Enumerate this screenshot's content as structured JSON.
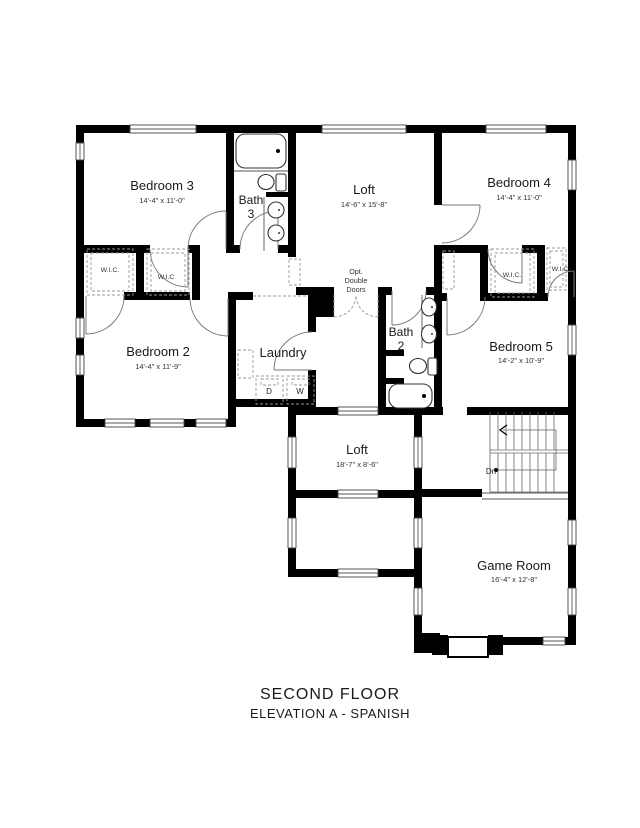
{
  "title": {
    "line1": "SECOND FLOOR",
    "line2": "ELEVATION A - SPANISH"
  },
  "rooms": {
    "bedroom3": {
      "name": "Bedroom 3",
      "dims": "14'-4\" x 11'-0\""
    },
    "bath3": {
      "name": "Bath",
      "number": "3"
    },
    "loft_upper": {
      "name": "Loft",
      "dims": "14'-6\" x 15'-8\""
    },
    "bedroom4": {
      "name": "Bedroom 4",
      "dims": "14'-4\" x 11'-0\""
    },
    "bedroom2": {
      "name": "Bedroom 2",
      "dims": "14'-4\" x 11'-9\""
    },
    "laundry": {
      "name": "Laundry"
    },
    "bath2": {
      "name": "Bath",
      "number": "2"
    },
    "bedroom5": {
      "name": "Bedroom 5",
      "dims": "14'-2\" x 10'-9\""
    },
    "loft_lower": {
      "name": "Loft",
      "dims": "18'-7\" x 8'-6\""
    },
    "game_room": {
      "name": "Game Room",
      "dims": "16'-4\" x 12'-8\""
    }
  },
  "closets": {
    "wic1": "W.I.C.",
    "wic2": "W.I.C",
    "wic3": "W.I.C.",
    "wic4": "W.I.C"
  },
  "annotations": {
    "dryer": "D",
    "washer": "W",
    "down": "Dn",
    "opt_doors": [
      "Opt.",
      "Double",
      "Doors"
    ]
  },
  "colors": {
    "wall": "#000000",
    "thin_line": "#555555",
    "door_line": "#777777",
    "dashed": "#999999",
    "background": "#ffffff"
  }
}
